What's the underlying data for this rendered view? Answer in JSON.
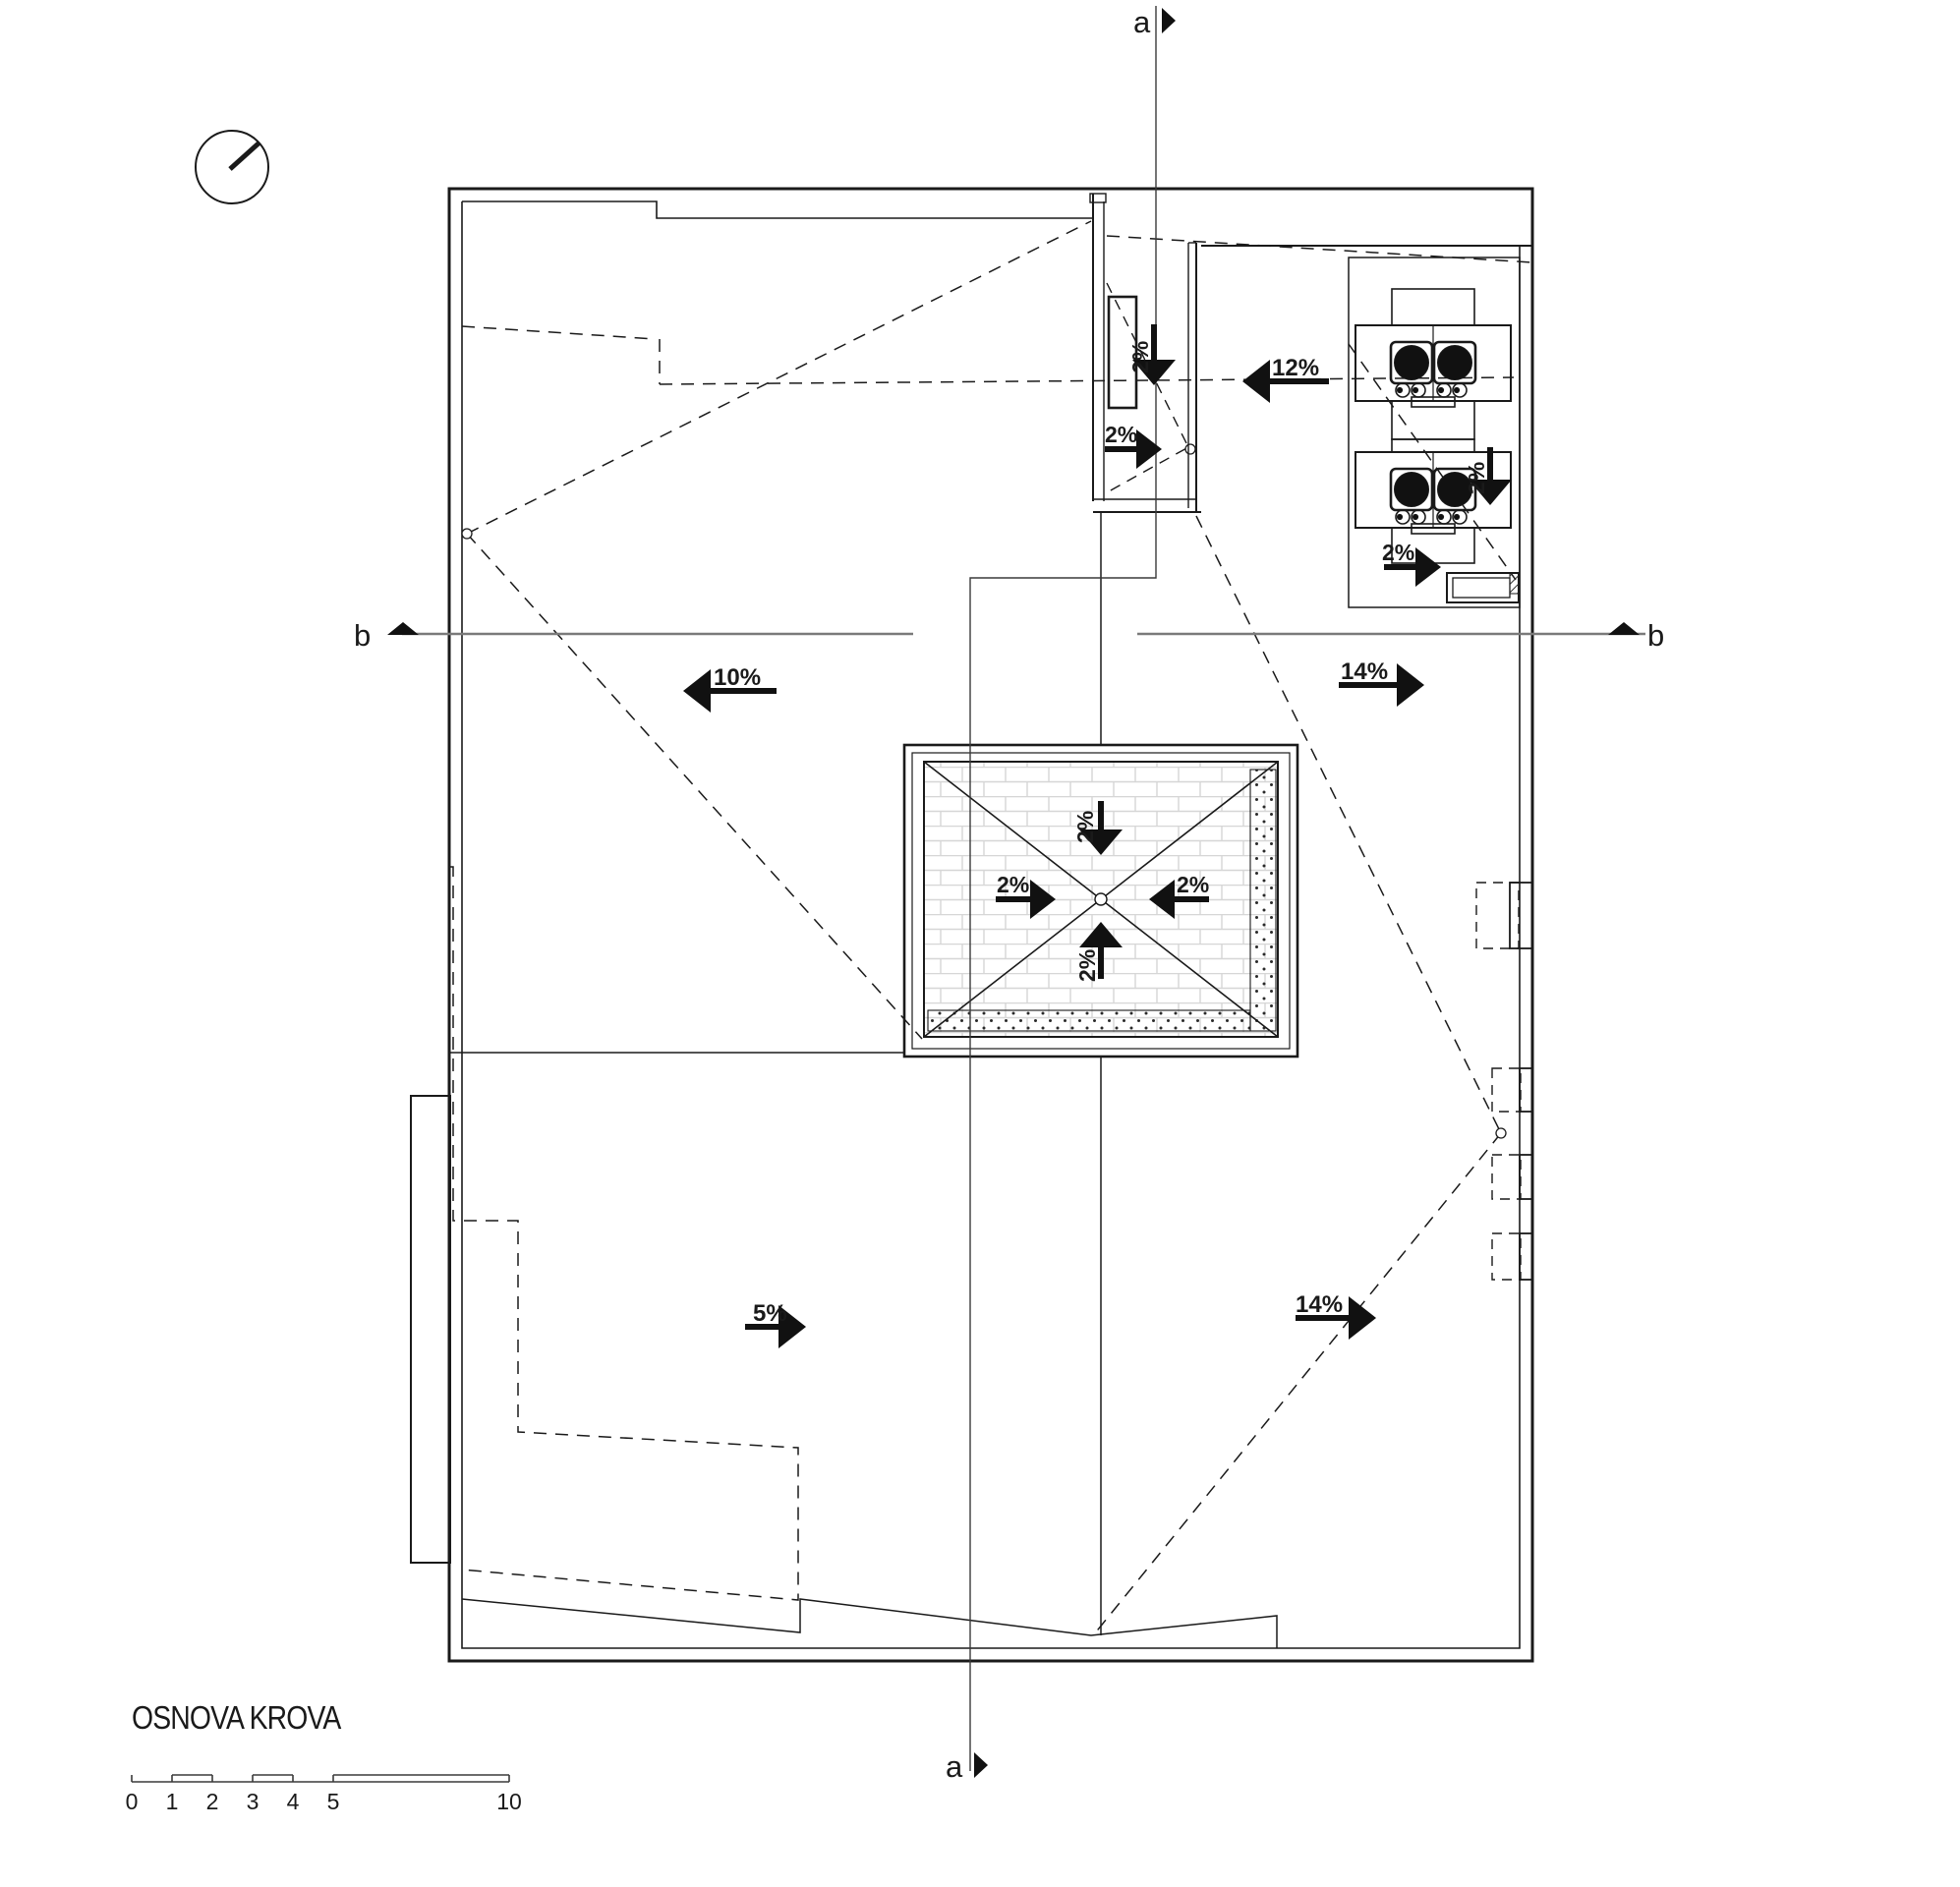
{
  "title_block": {
    "title": "OSNOVA KROVA"
  },
  "sections": {
    "a": "a",
    "b": "b"
  },
  "arrows": {
    "left_10": {
      "label": "10%",
      "direction": "left"
    },
    "top_12": {
      "label": "12%",
      "direction": "left"
    },
    "right_upper_14": {
      "label": "14%",
      "direction": "right"
    },
    "right_lower_14": {
      "label": "14%",
      "direction": "right"
    },
    "bottom_5": {
      "label": "5%",
      "direction": "right"
    },
    "channel_down_2": {
      "label": "2%",
      "direction": "down"
    },
    "channel_right_2": {
      "label": "2%",
      "direction": "right"
    },
    "hvac_down_2": {
      "label": "2%",
      "direction": "down"
    },
    "hvac_right_2": {
      "label": "2%",
      "direction": "right"
    },
    "skylight_top_2": {
      "label": "2%",
      "direction": "down"
    },
    "skylight_left_2": {
      "label": "2%",
      "direction": "right"
    },
    "skylight_right_2": {
      "label": "2%",
      "direction": "left"
    },
    "skylight_bottom_2": {
      "label": "2%",
      "direction": "up"
    }
  },
  "scale_bar": {
    "labels": [
      "0",
      "1",
      "2",
      "3",
      "4",
      "5",
      "10"
    ]
  },
  "colors": {
    "line": "#1a1a1a",
    "section_line": "#7a7a7a",
    "background": "#ffffff"
  }
}
